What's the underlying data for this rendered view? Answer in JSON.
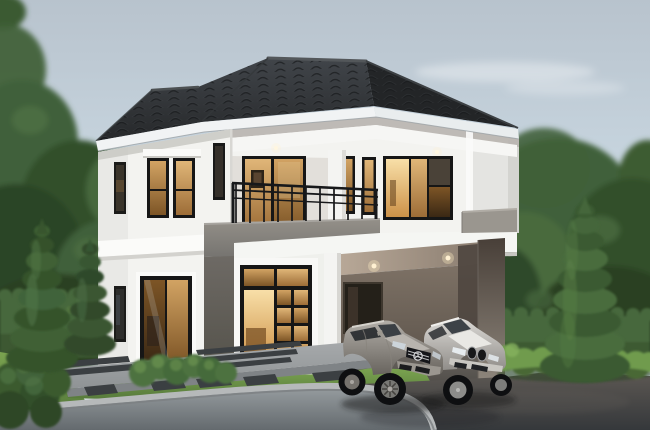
{
  "scene": {
    "type": "3d-architectural-rendering",
    "subject": "Modern two-storey house with dark hip roof, balcony, glowing warm windows, carport with two silver sedans, cypress trees, hedges and lawn at dusk",
    "objects": [
      "sky",
      "background-trees",
      "hedge",
      "cypress-trees",
      "two-storey-house",
      "hip-roof",
      "balcony",
      "carport",
      "mercedes-sedan",
      "bmw-sedan",
      "lawn",
      "walkway",
      "stepping-stones",
      "driveway",
      "road"
    ]
  },
  "colors": {
    "sky_top": "#b8c3cd",
    "sky_mid": "#cddce6",
    "sky_horizon": "#e6eef2",
    "roof_dark": "#26282a",
    "roof_light": "#41454a",
    "fascia": "#f1f3f4",
    "wall_white": "#f3f3f0",
    "wall_gray": "#949089",
    "wall_dark_gray": "#6e6a65",
    "carport_wall": "#483f38",
    "window_frame": "#161616",
    "window_glow": "#d2a363",
    "window_glow_deep": "#7d5526",
    "foliage_dark": "#32502b",
    "foliage_mid": "#41613a",
    "foliage_light": "#5d8048",
    "hedge_green": "#47683c",
    "bush_bright": "#6f9b4e",
    "grass": "#7ba450",
    "grass_dark": "#56793b",
    "concrete": "#a6a9ab",
    "stone_dark": "#3b3f42",
    "curb": "#b6b9ba",
    "road": "#9aa0a3",
    "road_dark": "#646a6e",
    "driveway": "#5e5954",
    "driveway_dark": "#35383b",
    "mercedes_silver": "#b2aea8",
    "bmw_silver": "#dcdad6",
    "tire_black": "#0e0f11"
  }
}
